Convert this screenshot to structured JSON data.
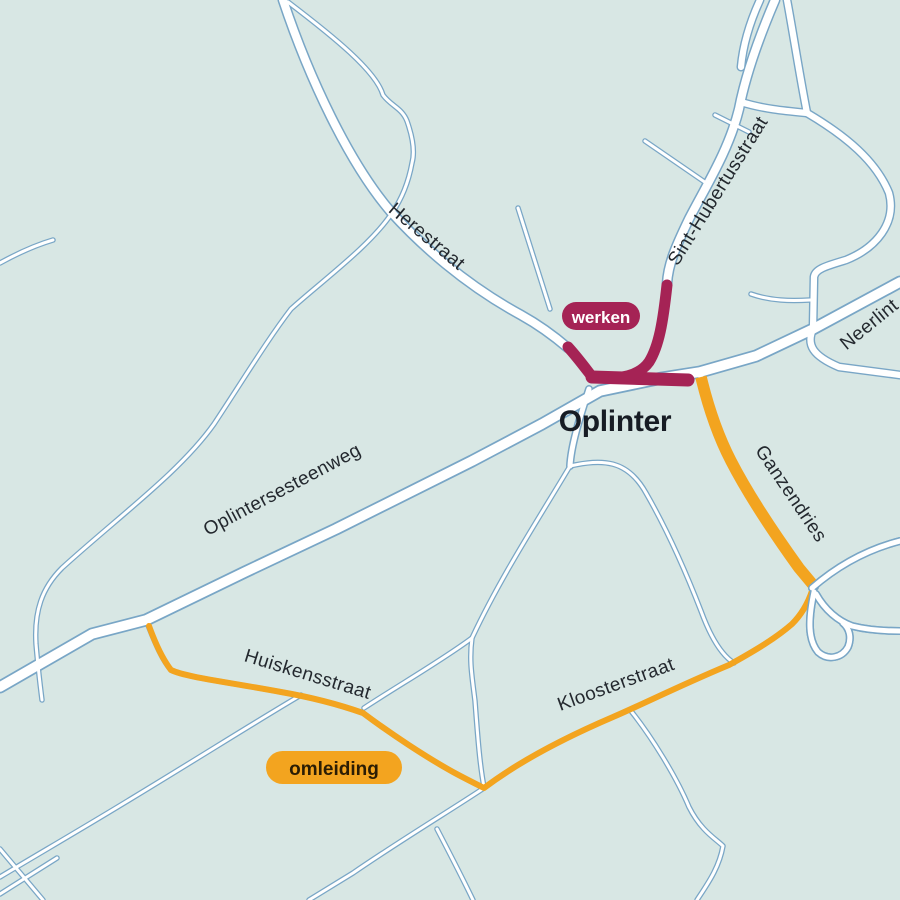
{
  "map": {
    "place": {
      "label": "Oplinter"
    },
    "streets": {
      "herestraat": "Herestraat",
      "sint_hubertusstraat": "Sint-Hubertusstraat",
      "neerlintersestraat": "Neerlint",
      "oplintersesteenweg": "Oplintersesteenweg",
      "ganzendries": "Ganzendries",
      "huiskensstraat": "Huiskensstraat",
      "kloosterstraat": "Kloosterstraat"
    },
    "badges": {
      "werken": "werken",
      "omleiding": "omleiding"
    },
    "colors": {
      "background": "#d8e7e4",
      "road_fill": "#ffffff",
      "road_casing": "#79a6c6",
      "works": "#a52355",
      "detour": "#f3a41f",
      "street_label": "#23282e",
      "place_label": "#171c24",
      "werken_text": "#ffffff",
      "omleiding_text": "#2b1d04"
    }
  }
}
